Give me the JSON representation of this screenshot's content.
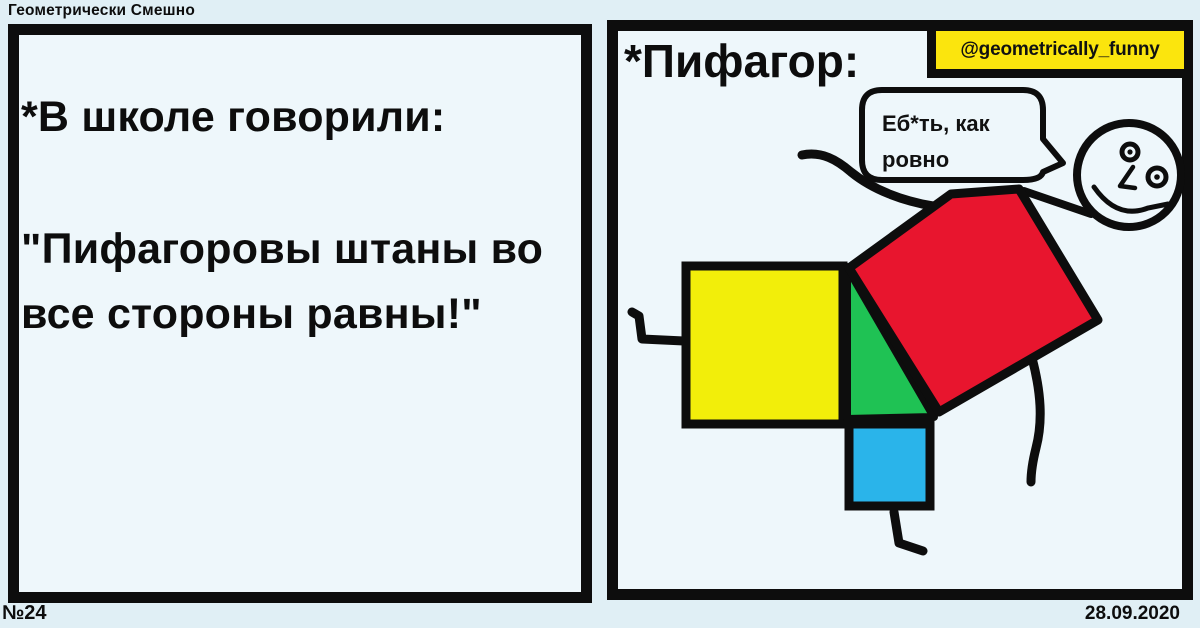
{
  "header": {
    "title": "Геометрически Смешно"
  },
  "footer": {
    "issue": "№24",
    "date": "28.09.2020"
  },
  "left_panel": {
    "intro": "*В школе говорили:",
    "quote": "\"Пифагоровы штаны во все стороны равны!\""
  },
  "right_panel": {
    "title": "*Пифагор:",
    "watermark": "@geometrically_funny",
    "bubble": {
      "line1": "Еб*ть, как",
      "line2": "ровно"
    }
  },
  "colors": {
    "page_bg": "#e0eff5",
    "panel_bg": "#eef7fb",
    "outline": "#0d0d0d",
    "yellow_square": "#f2ee0a",
    "green_triangle": "#1fc254",
    "blue_square": "#2ab4ea",
    "red_square": "#e8152e",
    "watermark_bg": "#fbe50d"
  }
}
